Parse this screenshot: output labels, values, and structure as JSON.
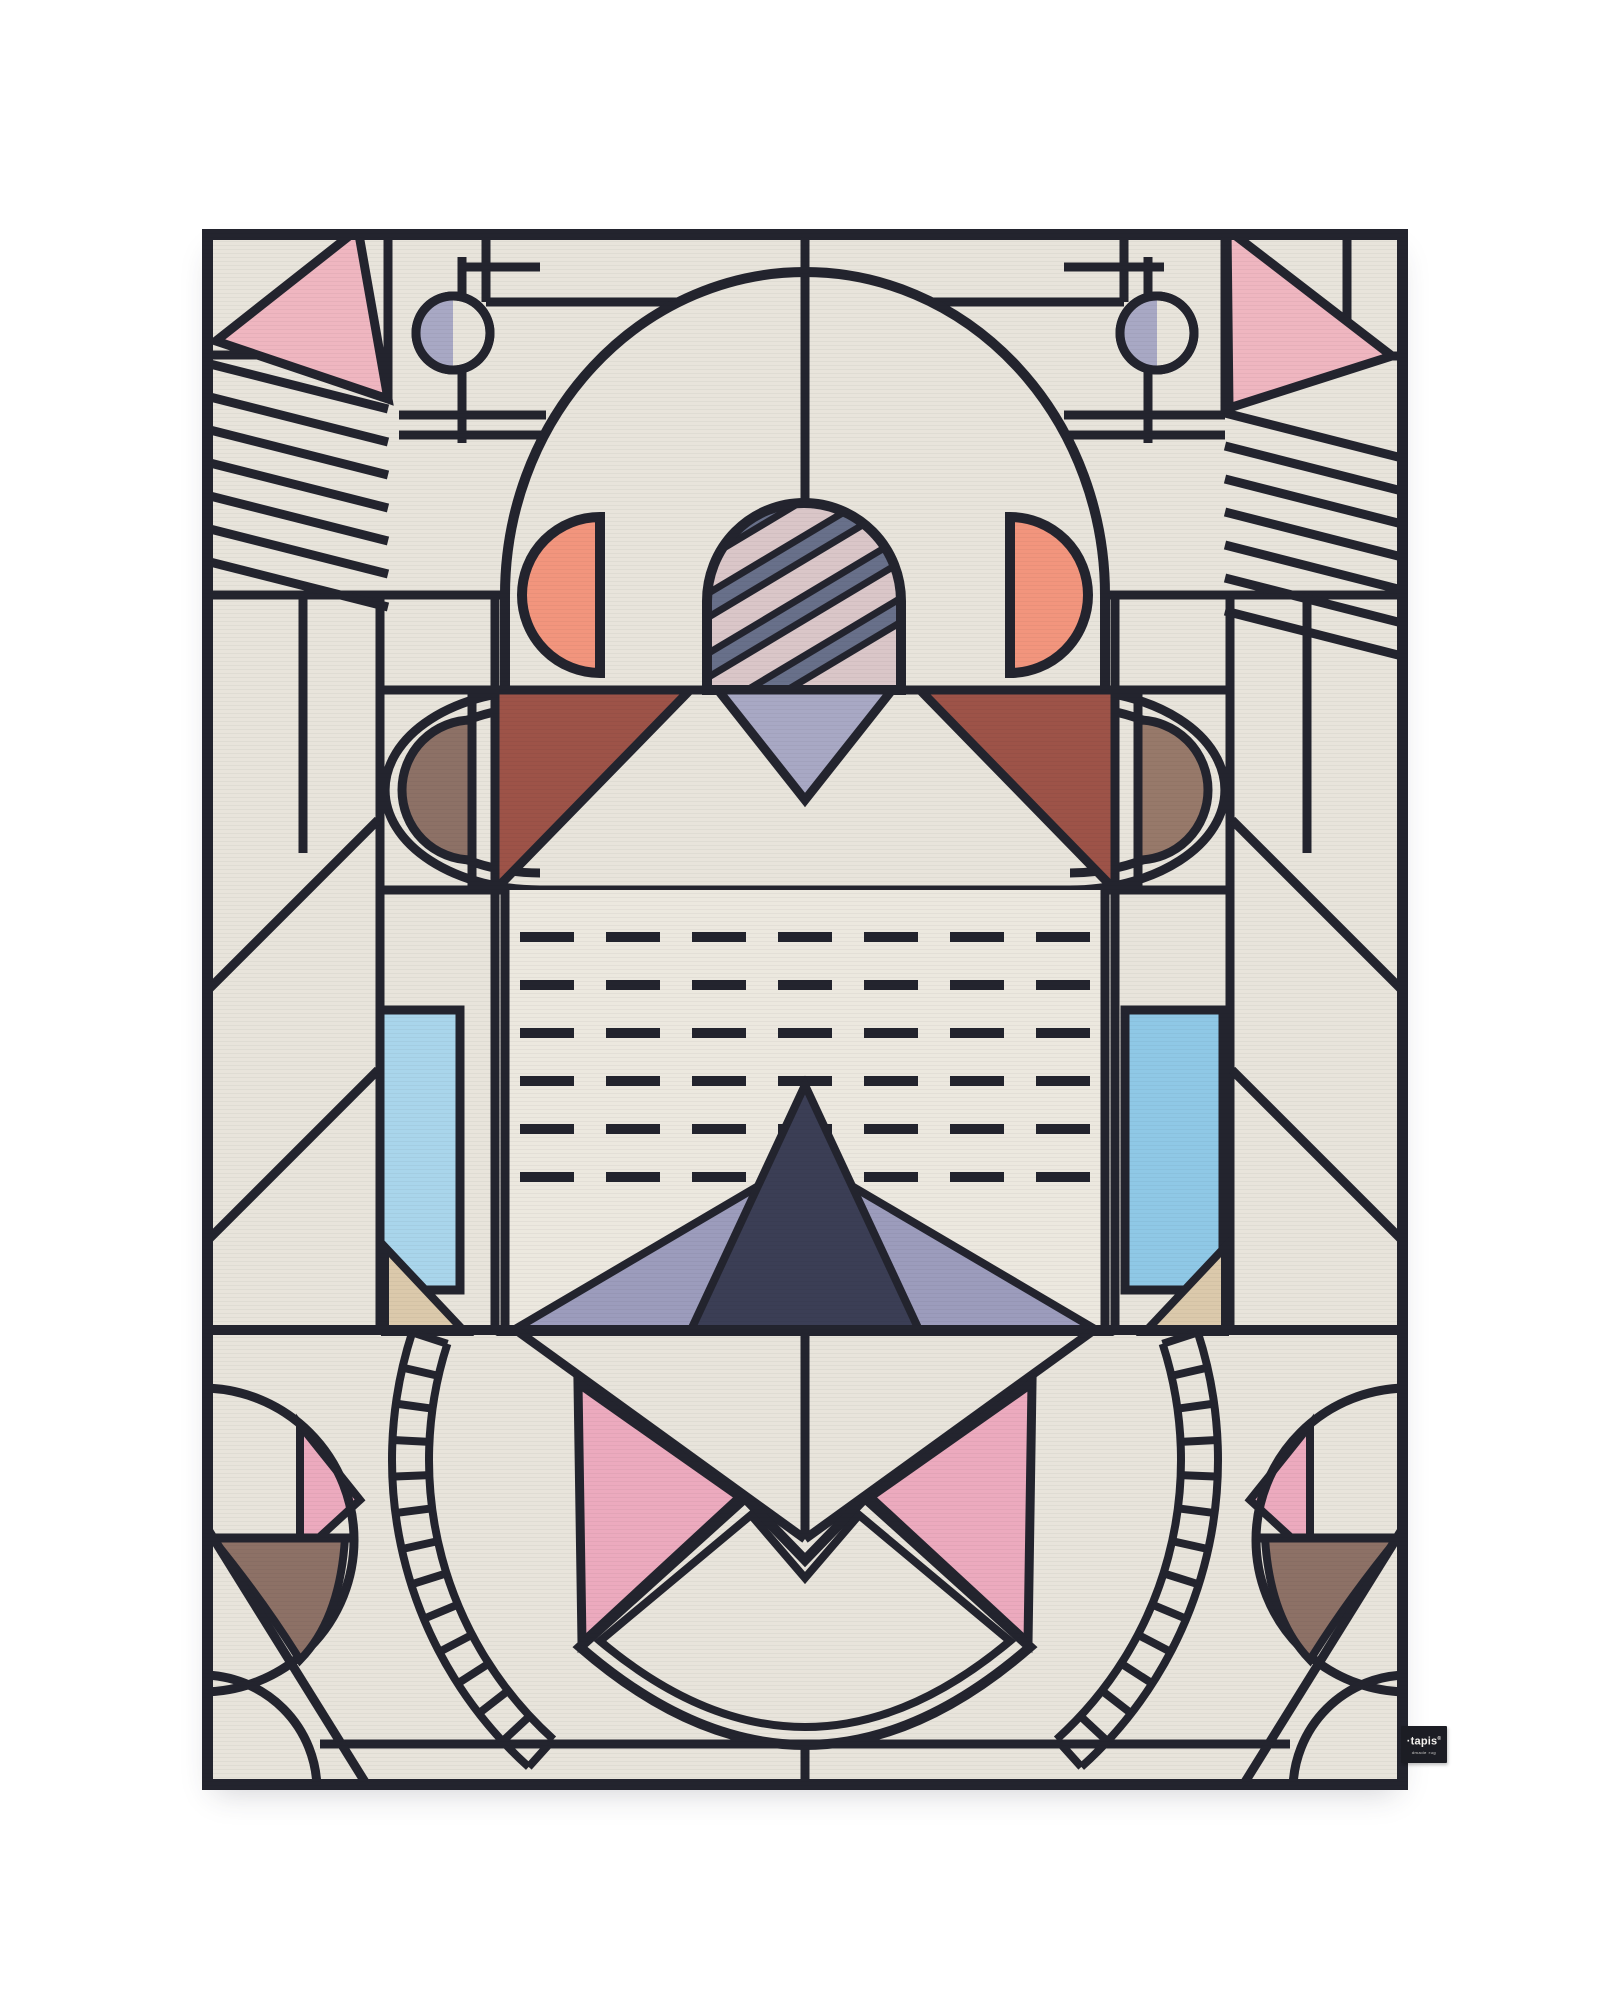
{
  "scene": {
    "type": "product photograph",
    "subject": "rectangular hand-made rug with pastel art-deco geometric pattern, portrait orientation, centered on a plain white background"
  },
  "label": {
    "brand": "·tapis",
    "registered": "®",
    "subtext": "dmade rug"
  },
  "palette": {
    "page_bg": "#ffffff",
    "ink": "#23242e",
    "cream": "#e8e4db",
    "cream_panel": "#ece8df",
    "pink_corner": "#efb6c0",
    "pink_bottom": "#ecaabe",
    "peach": "#f2957d",
    "maroon": "#9d5348",
    "taupe": "#8d7166",
    "taupe_light": "#97796a",
    "lavender": "#a8a8c4",
    "lavender_wing": "#9c9cbc",
    "capsule": "#dac6c8",
    "capsule_stripe": "#68708a",
    "navy": "#3b3e55",
    "blue_left": "#a9d5eb",
    "blue_right": "#8fc8e6",
    "sand": "#dbc9ab",
    "label_bg": "#1c1d24",
    "label_fg": "#f4f2ee"
  },
  "design": {
    "corner_stripes_left": 7,
    "corner_stripes_right": 7,
    "dash_rows": 6,
    "dash_cols": 7,
    "capsule_stripes": 4,
    "stair_rungs_per_side": 14
  }
}
